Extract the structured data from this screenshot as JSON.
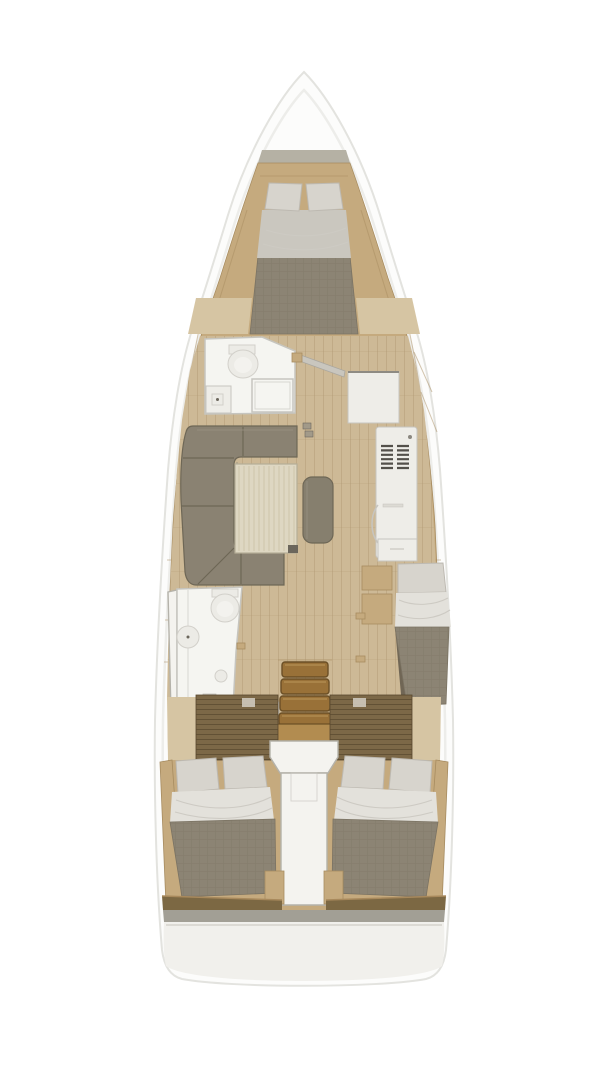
{
  "parts": {
    "hull": "sailboat hull outline",
    "anchor_locker": "bow anchor locker",
    "forward_cabin": "forward cabin double berth",
    "forward_head": "forward head with toilet, sink and shower",
    "door_forward_head": "open door between forward head and salon",
    "chart_table": "chart table",
    "galley_unit": "galley refrigerator / oven cabinet with vent grille",
    "salon": "salon with U-shaped sofa and table",
    "salon_table": "salon table",
    "salon_bench": "salon bench seat",
    "mast_post": "mast compression post",
    "aft_head": "aft head with toilet and sink",
    "companionway": "companionway stairs",
    "single_berth_cabin": "starboard single berth cabin",
    "aft_cabin_port": "port aft double cabin",
    "aft_cabin_starboard": "starboard aft double cabin",
    "engine_compartment": "engine compartment between aft cabins",
    "transom": "stern transom platform"
  },
  "colors": {
    "bg": "#ffffff",
    "hull": "#fcfcfb",
    "hull_line": "#e3e3df",
    "hull_inner": "#ededea",
    "anchor_gray": "#b5b1a4",
    "deck_wood": "#c5aa7e",
    "deck_wood_dark": "#a78c60",
    "floor_wood": "#cdb996",
    "floor_line": "#b49c76",
    "floor_light": "#d6c5a3",
    "room_white": "#f5f5f1",
    "room_wall": "#c6c5bf",
    "fixture": "#ecebe6",
    "fixture_line": "#d2d0ca",
    "cabinet": "#eeede8",
    "cabinet_line": "#c7c5bf",
    "vent": "#53504a",
    "sofa": "#8a8272",
    "sofa_dark": "#6e6756",
    "sofa_light": "#979080",
    "table": "#ded7c2",
    "table_line": "#c8bfa5",
    "table_border": "#b5ad97",
    "bench": "#867f6e",
    "mattress": "#8c8474",
    "mattress_line": "#7b7363",
    "pillow": "#d7d4cd",
    "pillow_line": "#bdb9b1",
    "sheet": "#e3e1db",
    "sheet_fwd": "#cac7bf",
    "sheet_line": "#cdcac3",
    "stair": "#997138",
    "stair_dark": "#6b4f26",
    "stair_light": "#b28c50",
    "stair_hl": "#c09a5e",
    "rail_white": "#eae9e4",
    "slat": "#7c6847",
    "slat_line": "#57472d",
    "landing": "#f4f3ef",
    "landing_line": "#b4b2aa",
    "foot_rail": "#7c6843",
    "stern_gray": "#a29f95",
    "transom": "#f1f0ec",
    "door": "#c9c6be",
    "door_edge": "#aaa79f",
    "mark_dark": "#6b665c",
    "shadow_dark": "#5f574a",
    "mast": "#a29a89"
  }
}
